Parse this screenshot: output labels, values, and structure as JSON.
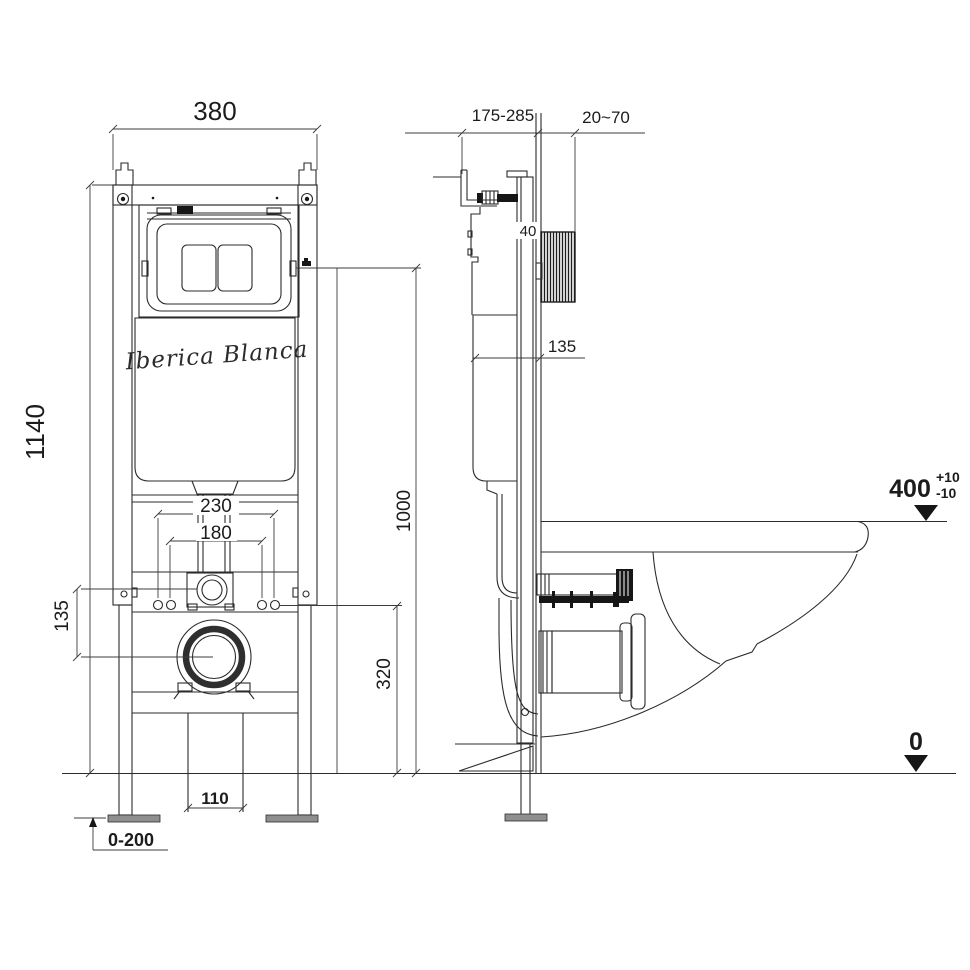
{
  "drawing": {
    "brand": "Iberica Blanca",
    "front_view": {
      "frame_width": "380",
      "frame_height": "1140",
      "fixing_spacing_outer": "230",
      "fixing_spacing_inner": "180",
      "inlet_to_drain_offset": "135",
      "drain_center_height": "320",
      "actuator_height": "1000",
      "outlet_width": "110",
      "leg_adjustment": "0-200"
    },
    "side_view": {
      "mounting_depth_range": "175-285",
      "wall_finish_range": "20~70",
      "rail_depth": "40",
      "cistern_wall_offset": "135",
      "rim_height": "400",
      "rim_tolerance_plus": "+10",
      "rim_tolerance_minus": "-10",
      "floor_level": "0"
    },
    "colors": {
      "line": "#2b2b2b",
      "fill_dark": "#161616",
      "foot_gray": "#8f8f8f"
    }
  }
}
